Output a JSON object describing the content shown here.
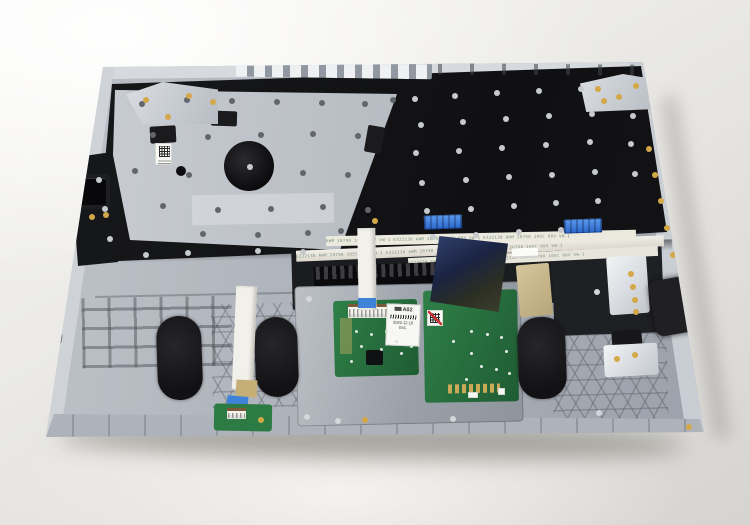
{
  "image_subject": "laptop palmrest keyboard assembly, internal rear view on white surface",
  "markings": {
    "flex_cable_print_1": "E322138 AWM 20798 105C 60V VW-1   E322138 AWM 20798 105C 60V VW-1   E322138 AWM 20798 105C 60V VW-1",
    "flex_cable_print_2": "AWM 20798 105C 60V VW-1 E322138   AWM 20798 105C 60V VW-1 E322138   AWM 20798 105C 60V VW-1",
    "flex_cable_print_3": "E322138 AWM 20798 105C 60V VW-1   E322138 AWM 20798 105C 60V VW-1",
    "ruler_scale": "50 45 40 35 30 25 20 15 10 05 0",
    "touchpad_label": {
      "model": "A02",
      "date": "2022.12.16",
      "grade": "EVL"
    }
  },
  "palette": {
    "background": "#eceae7",
    "case_silver": "#aab0b8",
    "keyboard_membrane_black": "#141416",
    "metal_plate": "#c0c5cb",
    "pcb_green": "#2e7d46",
    "flex_cable_navy": "#1d2744",
    "ffc_tab_blue": "#3a7fd6",
    "foam_pad_black": "#1b1b1d",
    "screw_gold": "#d2a848"
  }
}
